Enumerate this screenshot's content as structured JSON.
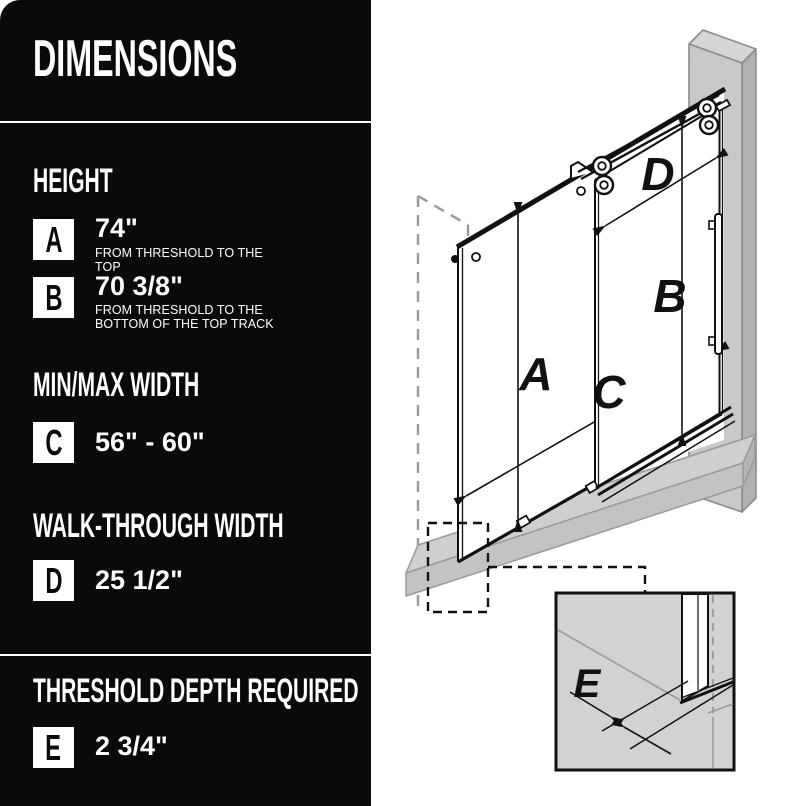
{
  "panel": {
    "title": "DIMENSIONS",
    "sections": [
      {
        "heading": "HEIGHT",
        "rows": [
          {
            "letter": "A",
            "value": "74\"",
            "description": "FROM THRESHOLD TO THE TOP"
          },
          {
            "letter": "B",
            "value": "70 3/8\"",
            "description": "FROM THRESHOLD TO THE BOTTOM OF THE TOP TRACK"
          }
        ]
      },
      {
        "heading": "MIN/MAX WIDTH",
        "rows": [
          {
            "letter": "C",
            "value": "56\" - 60\"",
            "description": ""
          }
        ]
      },
      {
        "heading": "WALK-THROUGH WIDTH",
        "rows": [
          {
            "letter": "D",
            "value": "25 1/2\"",
            "description": ""
          }
        ]
      },
      {
        "heading": "THRESHOLD DEPTH REQUIRED",
        "rows": [
          {
            "letter": "E",
            "value": "2 3/4\"",
            "description": ""
          }
        ]
      }
    ]
  },
  "diagram": {
    "labels": {
      "a": "A",
      "b": "B",
      "c": "C",
      "d": "D",
      "e": "E"
    }
  },
  "colors": {
    "panel_bg": "#0a0a0a",
    "panel_text": "#ffffff",
    "line_black": "#1a1a1a",
    "wall_gray": "#c9c9c9",
    "wall_top_gray": "#d6d6d6",
    "wall_side_gray": "#b2b2b2",
    "threshold_gray": "#cfcfcf",
    "inset_gray": "#d2d2d2",
    "dash_gray": "#999999"
  }
}
